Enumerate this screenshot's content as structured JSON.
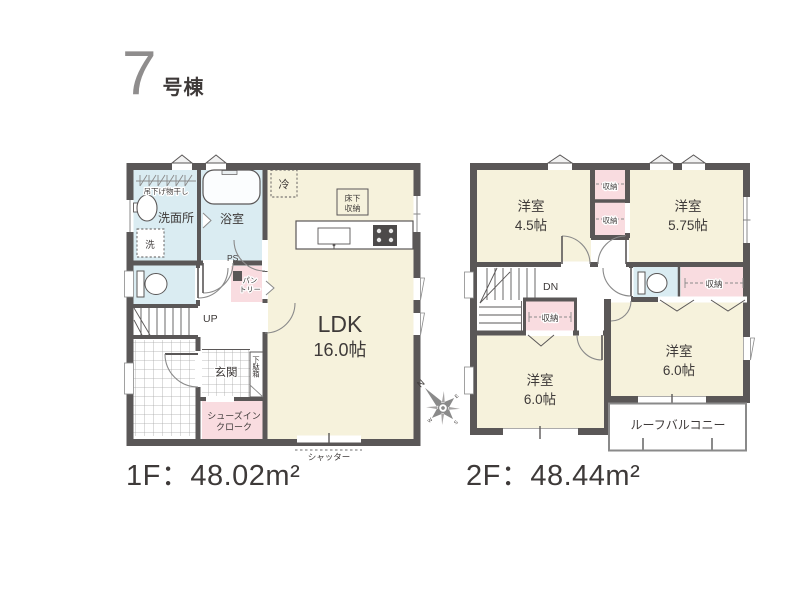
{
  "title": {
    "number": "7",
    "suffix": "号棟"
  },
  "colors": {
    "wall": "#5a5757",
    "room_cream": "#f6f2dc",
    "wet_area_blue": "#daecf2",
    "closet_pink": "#f9dce0",
    "line_gray": "#8a8a8a",
    "text": "#3e3a39",
    "title_gray": "#8f8d8d"
  },
  "compass": {
    "north": "N",
    "east": "E",
    "south": "S",
    "west": "W"
  },
  "f1": {
    "area_label": "1F：48.02m²",
    "ldk": {
      "name": "LDK",
      "size": "16.0帖"
    },
    "washroom": "洗面所",
    "laundry": "吊下げ物干し",
    "washer": "洗",
    "bathroom": "浴室",
    "fridge": "冷",
    "underfloor_line1": "床下",
    "underfloor_line2": "収納",
    "ps": "PS",
    "pantry_line1": "パン",
    "pantry_line2": "トリー",
    "up": "UP",
    "entrance": "玄関",
    "shoebox": "下駄箱",
    "sic_line1": "シューズイン",
    "sic_line2": "クローク",
    "shutter": "シャッター"
  },
  "f2": {
    "area_label": "2F：48.44m²",
    "room_45": {
      "name": "洋室",
      "size": "4.5帖"
    },
    "room_575": {
      "name": "洋室",
      "size": "5.75帖"
    },
    "room_60_right": {
      "name": "洋室",
      "size": "6.0帖"
    },
    "room_60_left": {
      "name": "洋室",
      "size": "6.0帖"
    },
    "closet_top": "収納",
    "closet_mid": "収納",
    "closet_hall": "収納",
    "closet_right": "収納",
    "dn": "DN",
    "balcony": "ルーフバルコニー"
  }
}
